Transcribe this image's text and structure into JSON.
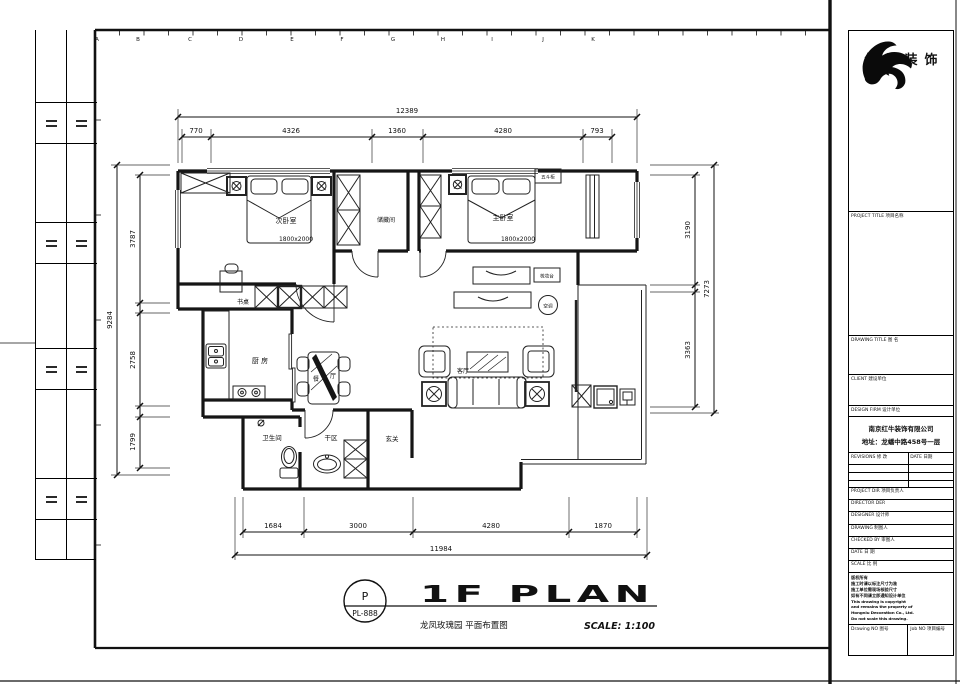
{
  "ruler": {
    "letters": [
      "A",
      "B",
      "C",
      "D",
      "E",
      "F",
      "G",
      "H",
      "I",
      "J",
      "K"
    ]
  },
  "plan": {
    "rooms": {
      "bedroom2": "次卧室",
      "bedroom2_bed_size": "1800x2000",
      "storage": "储藏间",
      "master": "主卧室",
      "master_bed_size": "1800x2000",
      "desk": "书桌",
      "kitchen": "厨 房",
      "dining_char_left": "餐",
      "dining_char_right": "厅",
      "living": "客厅",
      "bathroom": "卫生间",
      "dry_area": "干区",
      "entry": "玄关",
      "ac_unit": "空调",
      "chest_label": "五斗柜",
      "dresser_label": "梳妆台"
    },
    "dims": {
      "top": {
        "total": "12389",
        "segments": [
          "770",
          "4326",
          "1360",
          "4280",
          "793"
        ]
      },
      "bottom": {
        "total": "11984",
        "segments": [
          "1684",
          "3000",
          "4280",
          "1870"
        ]
      },
      "left": {
        "total": "9284",
        "segments": [
          "3787",
          "2758",
          "1799"
        ]
      },
      "right": {
        "total": "7273",
        "segments": [
          "3190",
          "3363"
        ]
      }
    }
  },
  "footer": {
    "stamp_letter": "P",
    "stamp_code": "PL-888",
    "title": "1F PLAN",
    "subtitle": "龙凤玫瑰园 平面布置图",
    "scale": "SCALE: 1:100"
  },
  "title_block": {
    "brand": "红牛装饰",
    "project_title": "PROJECT TITLE  项目名称",
    "drawing_title": "DRAWING TITLE  图 名",
    "client": "CLIENT  建设单位",
    "design_firm": "DESIGN FIRM  设计单位",
    "firm_name": "南京红牛装饰有限公司",
    "firm_addr": "地址：龙蟠中路458号一层",
    "revisions": "REVISIONS  修 改",
    "date_col": "DATE 日期",
    "project_dir": "PROJECT DIR  项目负责人",
    "director": "DIRECTOR DER",
    "designer": "DESIGNER  设计师",
    "drawing": "DRAWING  制图人",
    "checked": "CHECKED BY  审图人",
    "date": "DATE  日 期",
    "scale": "SCALE  比 例",
    "notes": [
      "版权所有",
      "施工时请以标注尺寸为准",
      "施工单位需现场核验尺寸",
      "如有不同请立即通知设计单位",
      "This drawing is copyright",
      "and remains the property of",
      "Hongniu Decoration Co., Ltd.",
      "Do not scale this drawing."
    ],
    "drawing_no": "Drawing NO  图号",
    "job_no": "Job NO  项目编号"
  }
}
